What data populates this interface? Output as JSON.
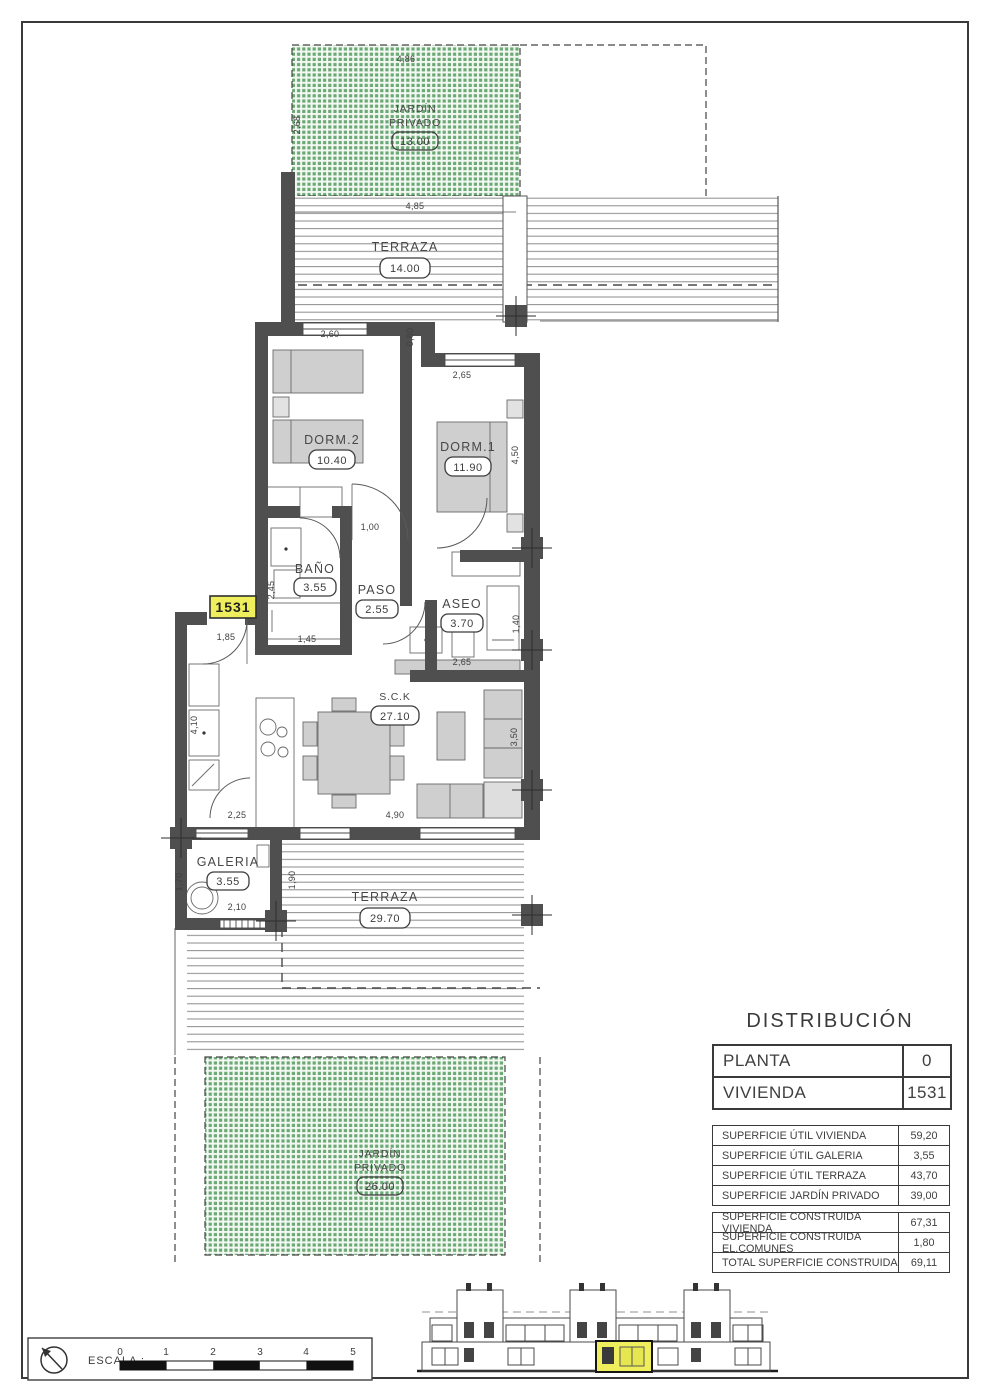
{
  "colors": {
    "garden_green": "#67a871",
    "wall_gray": "#4f4f4f",
    "highlight_yellow": "#efef5d"
  },
  "plan": {
    "unit_tag": "1531",
    "rooms": {
      "jardin_top": {
        "line1": "JARDÍN",
        "line2": "PRIVADO",
        "area": "13.00"
      },
      "terraza_top": {
        "name": "TERRAZA",
        "area": "14.00"
      },
      "dorm2": {
        "name": "DORM.2",
        "area": "10.40"
      },
      "dorm1": {
        "name": "DORM.1",
        "area": "11.90"
      },
      "bano": {
        "name": "BAÑO",
        "area": "3.55"
      },
      "paso": {
        "name": "PASO",
        "area": "2.55"
      },
      "aseo": {
        "name": "ASEO",
        "area": "3.70"
      },
      "sck": {
        "name": "S.C.K",
        "area": "27.10"
      },
      "galeria": {
        "name": "GALERIA",
        "area": "3.55"
      },
      "terraza_bottom": {
        "name": "TERRAZA",
        "area": "29.70"
      },
      "jardin_bottom": {
        "line1": "JARDÍN",
        "line2": "PRIVADO",
        "area": "26.00"
      }
    },
    "dims": {
      "garden_top_width": "4,86",
      "garden_top_depth": "2,68",
      "terrace_top_width": "4,85",
      "dorm2_width": "2,60",
      "terrace_step": "0,80",
      "dorm1_width": "2,65",
      "dorm1_depth": "4,50",
      "paso_width": "1,00",
      "bano_depth": "2,45",
      "bano_width": "1,45",
      "entry_width": "1,85",
      "aseo_width": "2,65",
      "aseo_depth": "1,40",
      "kitchen_depth": "4,10",
      "kitchen_width": "2,25",
      "living_width": "4,90",
      "living_depth": "3,50",
      "galeria_depth": "1,70",
      "galeria_width": "2,10",
      "terrace_offset": "1,90"
    }
  },
  "distribution": {
    "title": "DISTRIBUCIÓN",
    "header_rows": [
      {
        "label": "PLANTA",
        "value": "0"
      },
      {
        "label": "VIVIENDA",
        "value": "1531"
      }
    ],
    "util_rows": [
      {
        "label": "SUPERFICIE ÚTIL VIVIENDA",
        "value": "59,20"
      },
      {
        "label": "SUPERFICIE ÚTIL GALERIA",
        "value": "3,55"
      },
      {
        "label": "SUPERFICIE ÚTIL TERRAZA",
        "value": "43,70"
      },
      {
        "label": "SUPERFICIE JARDÍN PRIVADO",
        "value": "39,00"
      }
    ],
    "built_rows": [
      {
        "label": "SUPERFICIE CONSTRUIDA VIVIENDA",
        "value": "67,31"
      },
      {
        "label": "SUPERFICIE CONSTRUIDA EL.COMUNES",
        "value": "1,80"
      },
      {
        "label": "TOTAL SUPERFICIE CONSTRUIDA",
        "value": "69,11"
      }
    ]
  },
  "scale": {
    "label": "ESCALA :",
    "ticks": [
      "0",
      "1",
      "2",
      "3",
      "4",
      "5"
    ]
  }
}
